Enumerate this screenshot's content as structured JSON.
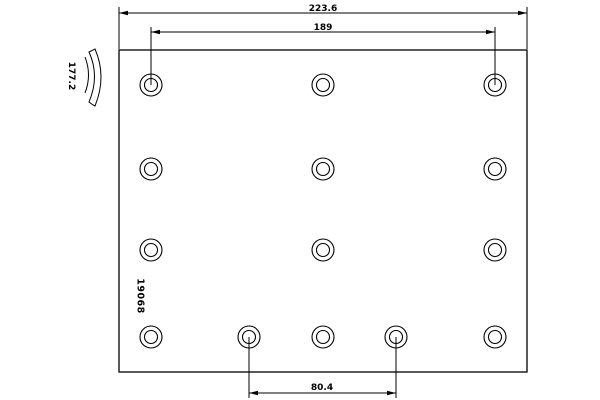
{
  "diagram": {
    "type": "technical-drawing",
    "subject": "brake-lining-plan-and-profile",
    "part_number": "19068",
    "dimensions": {
      "total_width": "223.6",
      "hole_span_width": "189",
      "height": "177.2",
      "bottom_hole_span": "80.4"
    },
    "holes": {
      "outer_radius": 11,
      "inner_radius": 6.5,
      "positions": [
        {
          "x": 151,
          "y": 85
        },
        {
          "x": 323,
          "y": 85
        },
        {
          "x": 495,
          "y": 85
        },
        {
          "x": 151,
          "y": 169
        },
        {
          "x": 323,
          "y": 169
        },
        {
          "x": 495,
          "y": 169
        },
        {
          "x": 151,
          "y": 250
        },
        {
          "x": 323,
          "y": 250
        },
        {
          "x": 495,
          "y": 250
        },
        {
          "x": 151,
          "y": 337
        },
        {
          "x": 249,
          "y": 337
        },
        {
          "x": 323,
          "y": 337
        },
        {
          "x": 396,
          "y": 337
        },
        {
          "x": 495,
          "y": 337
        }
      ]
    },
    "colors": {
      "line": "#000000",
      "background": "#ffffff"
    }
  }
}
